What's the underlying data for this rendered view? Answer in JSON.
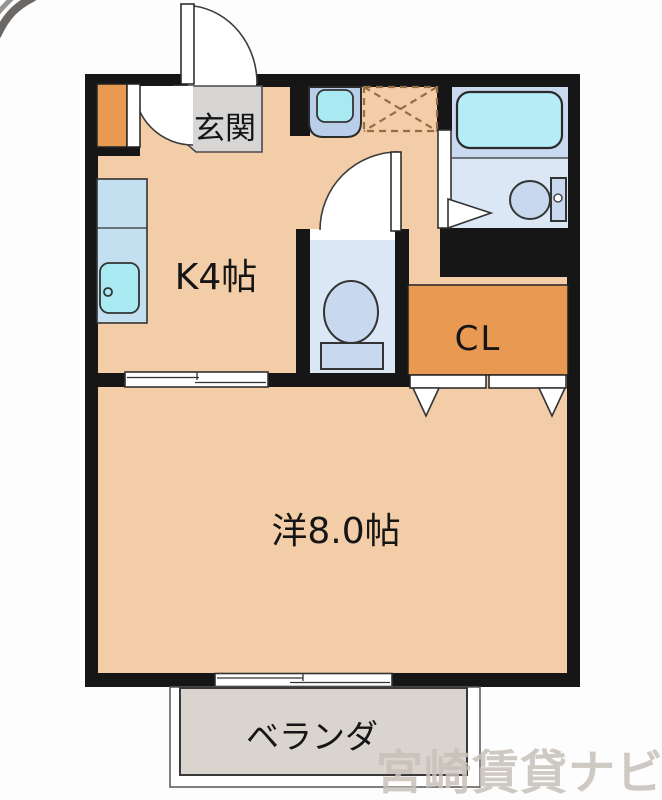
{
  "floorplan": {
    "labels": {
      "entrance": "玄関",
      "kitchen": "K4帖",
      "closet": "CL",
      "main_room": "洋8.0帖",
      "balcony": "ベランダ"
    },
    "watermark": "宮崎賃貸ナビ",
    "colors": {
      "wall": "#161616",
      "floor": "#f2cda7",
      "accent_orange": "#e89952",
      "entrance_gray": "#d8d6d5",
      "counter_blue": "#c4dff0",
      "sink_cyan": "#a9e9f2",
      "basin_blue": "#b9cfe9",
      "bath_floor": "#c9d9f0",
      "wc_floor": "#dbe7f5",
      "fixture_blue": "#c8d8ee",
      "bathtub_cyan": "#b5ecf5",
      "balcony_gray": "#dad4cf",
      "watermark_gray": "#c8c1b9",
      "laundry_dash": "#966e46"
    },
    "fixtures": {
      "entrance_door": "outward-swing-door",
      "shoe_cabinet": "shoe-cabinet",
      "kitchen_counter": "kitchen-counter",
      "kitchen_sink": "sink-with-faucet",
      "wash_basin": "wash-basin",
      "laundry_space": "washing-machine-pan",
      "wc_door": "inward-swing-door",
      "wc_toilet": "toilet",
      "bath_door": "bath-folding-door",
      "bathtub": "bathtub",
      "bath_toilet": "toilet",
      "room_divider_door": "sliding-door",
      "closet_doors": "folding-doors",
      "balcony_window": "sliding-window"
    }
  }
}
